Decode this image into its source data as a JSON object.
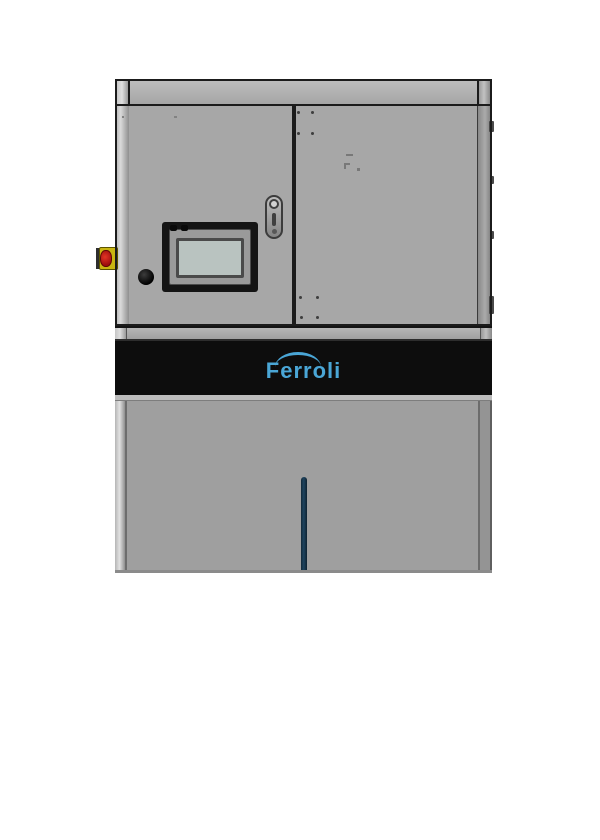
{
  "scene": {
    "description": "Front view product render of a Ferroli floor-standing boiler / control cabinet on a white background",
    "background_color": "#ffffff"
  },
  "brand_band": {
    "logo_text": "Ferroli",
    "logo_color": "#4aa6d6",
    "band_color": "#0d0d0d"
  },
  "cabinet": {
    "upper_panel_color": "#a7a7a7",
    "lower_panel_color": "#9f9f9f",
    "frame_outline_color": "#1b1b1b",
    "rail_color": "#b0b0b0"
  },
  "components": {
    "touchscreen_hmi": {
      "bezel_color": "#141414",
      "screen_color": "#b9c3c0"
    },
    "emergency_stop_button": {
      "housing_color": "#c9b511",
      "button_color": "#c01818"
    },
    "power_button": {
      "color": "#111111"
    },
    "door_latch": {
      "color": "#8f8f8f"
    },
    "level_indicator": {
      "color": "#1d3c55"
    }
  }
}
